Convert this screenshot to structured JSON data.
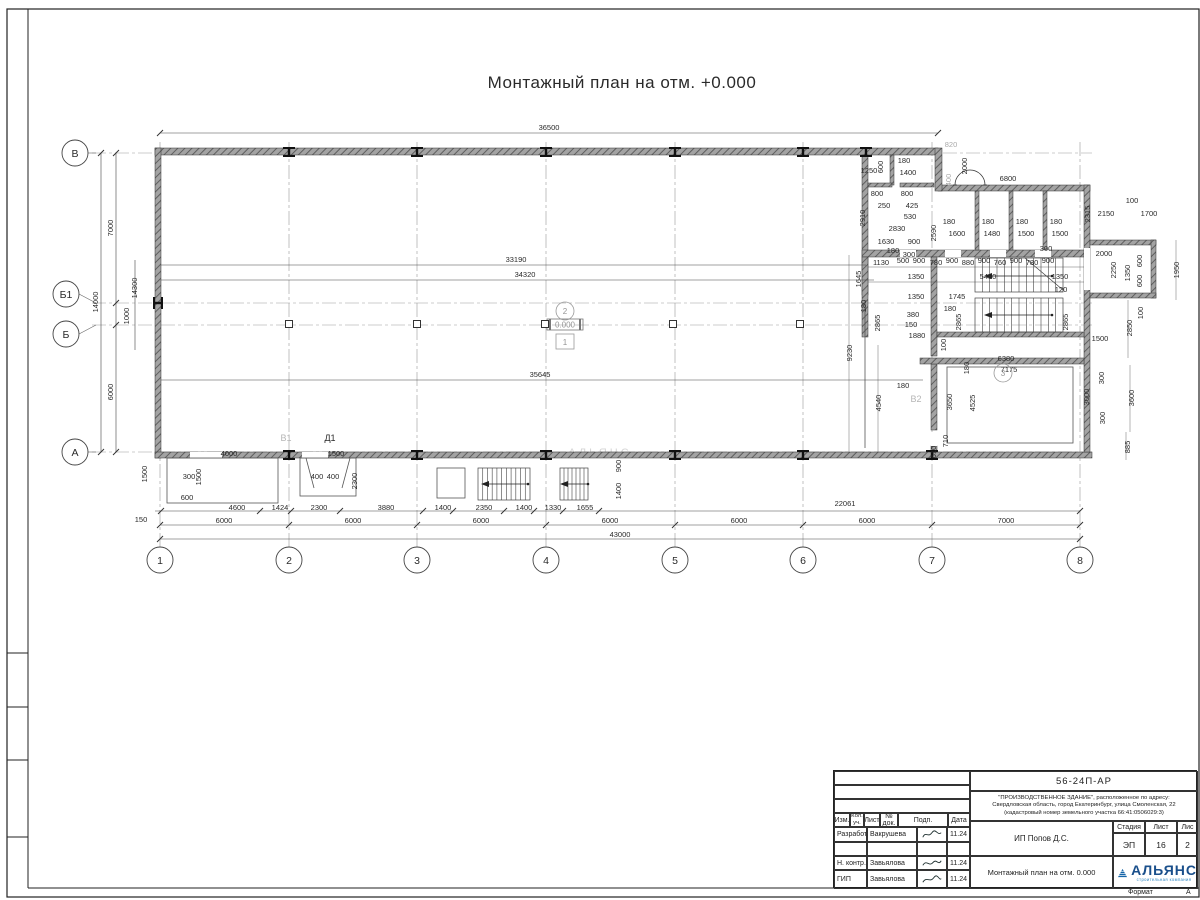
{
  "page_title": "Монтажный план на отм. +0.000",
  "watermark": "АЛЬЯНС",
  "elevation_mark": "0.000",
  "grid": {
    "columns": [
      {
        "label": "1",
        "x": 160
      },
      {
        "label": "2",
        "x": 289
      },
      {
        "label": "3",
        "x": 417
      },
      {
        "label": "4",
        "x": 546
      },
      {
        "label": "5",
        "x": 675
      },
      {
        "label": "6",
        "x": 803
      },
      {
        "label": "7",
        "x": 932
      },
      {
        "label": "8",
        "x": 1080
      }
    ],
    "rows": [
      {
        "label": "В",
        "bx": 75,
        "by": 153,
        "axis": 153
      },
      {
        "label": "Б1",
        "bx": 66,
        "by": 294,
        "axis": 303
      },
      {
        "label": "Б",
        "bx": 66,
        "by": 334,
        "axis": 325
      },
      {
        "label": "А",
        "bx": 75,
        "by": 452,
        "axis": 452
      }
    ]
  },
  "plan_labels": [
    {
      "text": "Д1",
      "x": 330,
      "y": 441,
      "gray": 0
    },
    {
      "text": "В1",
      "x": 286,
      "y": 441,
      "gray": 1
    },
    {
      "text": "В2",
      "x": 916,
      "y": 402,
      "gray": 1
    }
  ],
  "room_markers": [
    {
      "text": "2",
      "x": 565,
      "y": 311,
      "shape": "circle"
    },
    {
      "text": "1",
      "x": 565,
      "y": 342,
      "shape": "square"
    },
    {
      "text": "3",
      "x": 1003,
      "y": 373,
      "shape": "circle"
    }
  ],
  "dimensions": [
    [
      "36500",
      549,
      130,
      0,
      0
    ],
    [
      "33190",
      516,
      262,
      0,
      0
    ],
    [
      "34320",
      525,
      277,
      0,
      0
    ],
    [
      "35645",
      540,
      377,
      0,
      0
    ],
    [
      "43000",
      620,
      537,
      0,
      0
    ],
    [
      "14000",
      98,
      302,
      1,
      0
    ],
    [
      "7000",
      113,
      228,
      1,
      0
    ],
    [
      "6000",
      113,
      392,
      1,
      0
    ],
    [
      "14300",
      137,
      288,
      1,
      0
    ],
    [
      "1000",
      129,
      316,
      1,
      0
    ],
    [
      "1500",
      147,
      474,
      1,
      0
    ],
    [
      "150",
      141,
      522,
      0,
      0
    ],
    [
      "4600",
      237,
      510,
      0,
      0
    ],
    [
      "1424",
      280,
      510,
      0,
      0
    ],
    [
      "2300",
      319,
      510,
      0,
      0
    ],
    [
      "3880",
      386,
      510,
      0,
      0
    ],
    [
      "1400",
      443,
      510,
      0,
      0
    ],
    [
      "2350",
      484,
      510,
      0,
      0
    ],
    [
      "1400",
      524,
      510,
      0,
      0
    ],
    [
      "1330",
      553,
      510,
      0,
      0
    ],
    [
      "1655",
      585,
      510,
      0,
      0
    ],
    [
      "22061",
      845,
      506,
      0,
      0
    ],
    [
      "6000",
      224,
      523,
      0,
      0
    ],
    [
      "6000",
      353,
      523,
      0,
      0
    ],
    [
      "6000",
      481,
      523,
      0,
      0
    ],
    [
      "6000",
      610,
      523,
      0,
      0
    ],
    [
      "6000",
      739,
      523,
      0,
      0
    ],
    [
      "6000",
      867,
      523,
      0,
      0
    ],
    [
      "7000",
      1006,
      523,
      0,
      0
    ],
    [
      "300",
      189,
      479,
      0,
      0
    ],
    [
      "1500",
      201,
      477,
      1,
      0
    ],
    [
      "4000",
      229,
      456,
      0,
      0
    ],
    [
      "600",
      187,
      500,
      0,
      0
    ],
    [
      "1500",
      336,
      456,
      0,
      0
    ],
    [
      "400",
      317,
      479,
      0,
      0
    ],
    [
      "400",
      333,
      479,
      0,
      0
    ],
    [
      "2300",
      357,
      481,
      1,
      0
    ],
    [
      "900",
      621,
      466,
      1,
      0
    ],
    [
      "1400",
      621,
      491,
      1,
      0
    ],
    [
      "1250",
      869,
      173,
      0,
      0
    ],
    [
      "600",
      883,
      167,
      1,
      0
    ],
    [
      "180",
      904,
      163,
      0,
      0
    ],
    [
      "1400",
      908,
      175,
      0,
      0
    ],
    [
      "820",
      951,
      147,
      0,
      1
    ],
    [
      "2000",
      967,
      166,
      1,
      0
    ],
    [
      "400",
      951,
      180,
      1,
      1
    ],
    [
      "6800",
      1008,
      181,
      0,
      0
    ],
    [
      "800",
      877,
      196,
      0,
      0
    ],
    [
      "800",
      907,
      196,
      0,
      0
    ],
    [
      "250",
      884,
      208,
      0,
      0
    ],
    [
      "425",
      912,
      208,
      0,
      0
    ],
    [
      "530",
      910,
      219,
      0,
      0
    ],
    [
      "2830",
      897,
      231,
      0,
      0
    ],
    [
      "2910",
      865,
      218,
      1,
      0
    ],
    [
      "1630",
      886,
      244,
      0,
      0
    ],
    [
      "900",
      914,
      244,
      0,
      0
    ],
    [
      "180",
      893,
      253,
      0,
      0
    ],
    [
      "300",
      909,
      257,
      0,
      0
    ],
    [
      "180",
      949,
      224,
      0,
      0
    ],
    [
      "1600",
      957,
      236,
      0,
      0
    ],
    [
      "2590",
      936,
      233,
      1,
      0
    ],
    [
      "180",
      988,
      224,
      0,
      0
    ],
    [
      "1480",
      992,
      236,
      0,
      0
    ],
    [
      "180",
      1022,
      224,
      0,
      0
    ],
    [
      "1500",
      1026,
      236,
      0,
      0
    ],
    [
      "180",
      1056,
      224,
      0,
      0
    ],
    [
      "1500",
      1060,
      236,
      0,
      0
    ],
    [
      "300",
      1046,
      251,
      0,
      0
    ],
    [
      "2315",
      1090,
      214,
      1,
      0
    ],
    [
      "1130",
      881,
      265,
      0,
      0
    ],
    [
      "500",
      903,
      263,
      0,
      0
    ],
    [
      "900",
      919,
      263,
      0,
      0
    ],
    [
      "780",
      936,
      265,
      0,
      0
    ],
    [
      "900",
      952,
      263,
      0,
      0
    ],
    [
      "880",
      968,
      265,
      0,
      0
    ],
    [
      "900",
      984,
      263,
      0,
      0
    ],
    [
      "760",
      1000,
      265,
      0,
      0
    ],
    [
      "900",
      1016,
      263,
      0,
      0
    ],
    [
      "780",
      1032,
      265,
      0,
      0
    ],
    [
      "900",
      1048,
      263,
      0,
      0
    ],
    [
      "1645",
      861,
      279,
      1,
      0
    ],
    [
      "1350",
      916,
      279,
      0,
      0
    ],
    [
      "5480",
      988,
      279,
      0,
      0
    ],
    [
      "1350",
      1060,
      279,
      0,
      0
    ],
    [
      "2150",
      1106,
      216,
      0,
      0
    ],
    [
      "100",
      1132,
      203,
      0,
      0
    ],
    [
      "1700",
      1149,
      216,
      0,
      0
    ],
    [
      "2000",
      1104,
      256,
      0,
      0
    ],
    [
      "2250",
      1116,
      270,
      1,
      0
    ],
    [
      "1350",
      1130,
      273,
      1,
      0
    ],
    [
      "600",
      1142,
      261,
      1,
      0
    ],
    [
      "600",
      1142,
      281,
      1,
      0
    ],
    [
      "1950",
      1179,
      270,
      1,
      0
    ],
    [
      "100",
      1143,
      313,
      1,
      0
    ],
    [
      "1350",
      916,
      299,
      0,
      0
    ],
    [
      "1745",
      957,
      299,
      0,
      0
    ],
    [
      "120",
      1061,
      292,
      0,
      0
    ],
    [
      "180",
      866,
      306,
      1,
      0
    ],
    [
      "2865",
      880,
      323,
      1,
      0
    ],
    [
      "380",
      913,
      317,
      0,
      0
    ],
    [
      "150",
      911,
      327,
      0,
      0
    ],
    [
      "1880",
      917,
      338,
      0,
      0
    ],
    [
      "180",
      950,
      311,
      0,
      0
    ],
    [
      "2865",
      961,
      322,
      1,
      0
    ],
    [
      "2865",
      1068,
      322,
      1,
      0
    ],
    [
      "100",
      946,
      345,
      1,
      0
    ],
    [
      "6380",
      1006,
      361,
      0,
      0
    ],
    [
      "7175",
      1009,
      372,
      0,
      0
    ],
    [
      "180",
      969,
      368,
      1,
      0
    ],
    [
      "9230",
      852,
      353,
      1,
      0
    ],
    [
      "4540",
      881,
      403,
      1,
      0
    ],
    [
      "3650",
      952,
      402,
      1,
      0
    ],
    [
      "4525",
      975,
      403,
      1,
      0
    ],
    [
      "180",
      903,
      388,
      0,
      0
    ],
    [
      "710",
      948,
      441,
      1,
      0
    ],
    [
      "610",
      936,
      452,
      1,
      0
    ],
    [
      "2850",
      1132,
      328,
      1,
      0
    ],
    [
      "1500",
      1100,
      341,
      0,
      0
    ],
    [
      "300",
      1104,
      378,
      1,
      0
    ],
    [
      "3000",
      1089,
      397,
      1,
      0
    ],
    [
      "300",
      1105,
      418,
      1,
      0
    ],
    [
      "3600",
      1134,
      398,
      1,
      0
    ],
    [
      "885",
      1130,
      447,
      1,
      0
    ]
  ],
  "title_block": {
    "doc_number": "56-24П-АР",
    "project_line1": "\"ПРОИЗВОДСТВЕННОЕ ЗДАНИЕ\", расположенное по адресу:",
    "project_line2": "Свердловская область, город Екатеринбург, улица Смоленская, 22",
    "project_line3": "(кадастровый номер земельного участка 66:41:0506029:3)",
    "client": "ИП Попов Д.С.",
    "drawing_title": "Монтажный план на отм. 0.000",
    "stage_label": "Стадия",
    "sheet_label": "Лист",
    "sheets_label": "Лис",
    "stage_value": "ЭП",
    "sheet_value": "16",
    "sheets_value": "2",
    "header_cols": [
      "Изм.",
      "Кол. уч.",
      "Лист",
      "№ док.",
      "Подп.",
      "Дата"
    ],
    "rows": [
      {
        "role": "Разработал",
        "name": "Вакрушева",
        "date": "11.24"
      },
      {
        "role": "Н. контр.",
        "name": "Завьялова",
        "date": "11.24"
      },
      {
        "role": "ГИП",
        "name": "Завьялова",
        "date": "11.24"
      }
    ],
    "company": "АЛЬЯНС",
    "company_sub": "строительная компания",
    "format_label": "Формат",
    "format_value": "А"
  }
}
